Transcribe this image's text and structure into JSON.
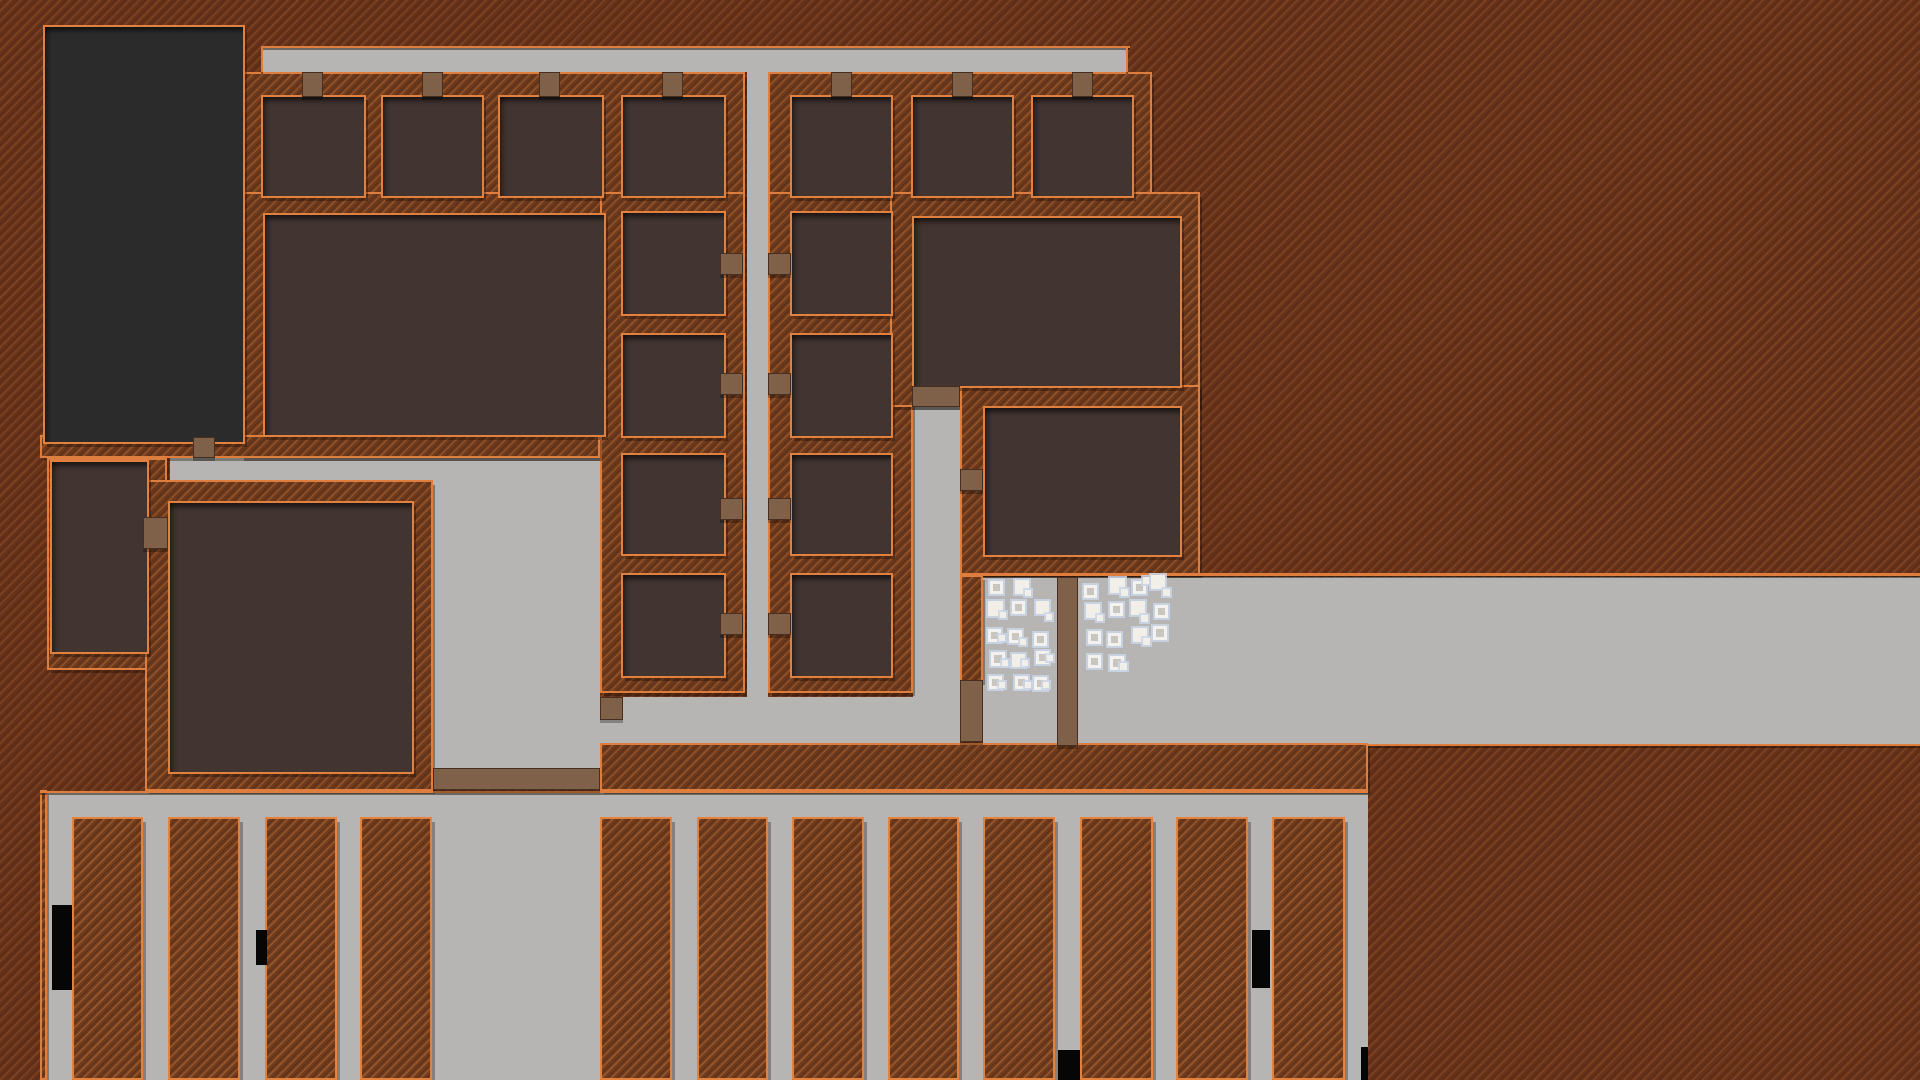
{
  "scene": {
    "description": "top-down colony builder game map, no visible text HUD",
    "palette": {
      "dirt": "#67321a",
      "dirt_stripe_light": "#7b4424",
      "dirt_stripe_dark": "#5d2b13",
      "wall_outline_orange": "#de7e3e",
      "room_interior": "#413431",
      "large_building_interior": "#2b2b2b",
      "road_gray": "#b6b5b3",
      "door_brown": "#7f6049",
      "item_white": "#f2efe9",
      "item_halo": "#cbd6e8",
      "debris_black": "#060606"
    }
  },
  "map": {
    "roads": [
      {
        "name": "top-road",
        "x": 263,
        "y": 48,
        "w": 865,
        "h": 24
      },
      {
        "name": "mid-vertical-road",
        "x": 747,
        "y": 72,
        "w": 21,
        "h": 671
      },
      {
        "name": "upper-left-road",
        "x": 170,
        "y": 458,
        "w": 263,
        "h": 22
      },
      {
        "name": "central-plaza",
        "x": 433,
        "y": 458,
        "w": 167,
        "h": 310
      },
      {
        "name": "south-corridor",
        "x": 600,
        "y": 697,
        "w": 313,
        "h": 46
      },
      {
        "name": "east-vertical-corridor",
        "x": 913,
        "y": 406,
        "w": 47,
        "h": 339
      },
      {
        "name": "east-main-road",
        "x": 983,
        "y": 577,
        "w": 937,
        "h": 168
      },
      {
        "name": "farm-yard-floor",
        "x": 47,
        "y": 793,
        "w": 1321,
        "h": 287
      }
    ],
    "wall_blocks": [
      {
        "name": "top-row-left-walls",
        "x": 240,
        "y": 72,
        "w": 505,
        "h": 143
      },
      {
        "name": "top-row-right-walls",
        "x": 768,
        "y": 72,
        "w": 384,
        "h": 143
      },
      {
        "name": "hall-block-walls",
        "x": 240,
        "y": 192,
        "w": 385,
        "h": 266
      },
      {
        "name": "left-column-walls",
        "x": 600,
        "y": 192,
        "w": 145,
        "h": 501
      },
      {
        "name": "right-column-walls",
        "x": 768,
        "y": 192,
        "w": 145,
        "h": 501
      },
      {
        "name": "northeast-hall-walls",
        "x": 890,
        "y": 192,
        "w": 310,
        "h": 215
      },
      {
        "name": "east-room-walls",
        "x": 960,
        "y": 385,
        "w": 240,
        "h": 190
      },
      {
        "name": "corridor-east-wall",
        "x": 960,
        "y": 575,
        "w": 23,
        "h": 107
      },
      {
        "name": "south-wall-slab",
        "x": 600,
        "y": 743,
        "w": 768,
        "h": 48
      },
      {
        "name": "building-south-wall",
        "x": 40,
        "y": 435,
        "w": 560,
        "h": 23
      },
      {
        "name": "small-room-walls",
        "x": 47,
        "y": 458,
        "w": 120,
        "h": 212
      },
      {
        "name": "left-hall-walls",
        "x": 145,
        "y": 480,
        "w": 288,
        "h": 311
      },
      {
        "name": "farm-left-wall",
        "x": 40,
        "y": 790,
        "w": 7,
        "h": 290
      }
    ],
    "rooms": [
      {
        "name": "large-dark-building",
        "x": 45,
        "y": 27,
        "w": 194,
        "h": 411,
        "variant": "dark"
      },
      {
        "name": "top-cell-1",
        "x": 263,
        "y": 97,
        "w": 97,
        "h": 95
      },
      {
        "name": "top-cell-2",
        "x": 383,
        "y": 97,
        "w": 95,
        "h": 95
      },
      {
        "name": "top-cell-3",
        "x": 500,
        "y": 97,
        "w": 98,
        "h": 95
      },
      {
        "name": "top-cell-4",
        "x": 623,
        "y": 97,
        "w": 97,
        "h": 95
      },
      {
        "name": "top-cell-5",
        "x": 792,
        "y": 97,
        "w": 95,
        "h": 95
      },
      {
        "name": "top-cell-6",
        "x": 913,
        "y": 97,
        "w": 95,
        "h": 95
      },
      {
        "name": "top-cell-7",
        "x": 1033,
        "y": 97,
        "w": 95,
        "h": 95
      },
      {
        "name": "central-hall",
        "x": 265,
        "y": 215,
        "w": 335,
        "h": 216
      },
      {
        "name": "left-col-cell-1",
        "x": 623,
        "y": 213,
        "w": 97,
        "h": 97
      },
      {
        "name": "left-col-cell-2",
        "x": 623,
        "y": 335,
        "w": 97,
        "h": 97
      },
      {
        "name": "left-col-cell-3",
        "x": 623,
        "y": 455,
        "w": 97,
        "h": 95
      },
      {
        "name": "left-col-cell-4",
        "x": 623,
        "y": 575,
        "w": 97,
        "h": 97
      },
      {
        "name": "right-col-cell-1",
        "x": 792,
        "y": 213,
        "w": 95,
        "h": 97
      },
      {
        "name": "right-col-cell-2",
        "x": 792,
        "y": 335,
        "w": 95,
        "h": 97
      },
      {
        "name": "right-col-cell-3",
        "x": 792,
        "y": 455,
        "w": 95,
        "h": 95
      },
      {
        "name": "right-col-cell-4",
        "x": 792,
        "y": 575,
        "w": 95,
        "h": 97
      },
      {
        "name": "northeast-hall",
        "x": 914,
        "y": 218,
        "w": 262,
        "h": 164
      },
      {
        "name": "east-room",
        "x": 985,
        "y": 408,
        "w": 191,
        "h": 143
      },
      {
        "name": "small-west-room",
        "x": 52,
        "y": 462,
        "w": 91,
        "h": 186
      },
      {
        "name": "left-hall",
        "x": 170,
        "y": 503,
        "w": 238,
        "h": 265
      }
    ],
    "doors": [
      {
        "name": "top-cell-1-door",
        "x": 302,
        "y": 72,
        "w": 21,
        "h": 25
      },
      {
        "name": "top-cell-2-door",
        "x": 422,
        "y": 72,
        "w": 21,
        "h": 25
      },
      {
        "name": "top-cell-3-door",
        "x": 539,
        "y": 72,
        "w": 21,
        "h": 25
      },
      {
        "name": "top-cell-4-door",
        "x": 662,
        "y": 72,
        "w": 21,
        "h": 25
      },
      {
        "name": "top-cell-5-door",
        "x": 831,
        "y": 72,
        "w": 21,
        "h": 25
      },
      {
        "name": "top-cell-6-door",
        "x": 952,
        "y": 72,
        "w": 21,
        "h": 25
      },
      {
        "name": "top-cell-7-door",
        "x": 1072,
        "y": 72,
        "w": 21,
        "h": 25
      },
      {
        "name": "left-col-door-1",
        "x": 720,
        "y": 253,
        "w": 23,
        "h": 22
      },
      {
        "name": "left-col-door-2",
        "x": 720,
        "y": 373,
        "w": 23,
        "h": 22
      },
      {
        "name": "left-col-door-3",
        "x": 720,
        "y": 498,
        "w": 23,
        "h": 22
      },
      {
        "name": "left-col-door-4",
        "x": 720,
        "y": 613,
        "w": 23,
        "h": 22
      },
      {
        "name": "right-col-door-1",
        "x": 768,
        "y": 253,
        "w": 23,
        "h": 22
      },
      {
        "name": "right-col-door-2",
        "x": 768,
        "y": 373,
        "w": 23,
        "h": 22
      },
      {
        "name": "right-col-door-3",
        "x": 768,
        "y": 498,
        "w": 23,
        "h": 22
      },
      {
        "name": "right-col-door-4",
        "x": 768,
        "y": 613,
        "w": 23,
        "h": 22
      },
      {
        "name": "large-building-door",
        "x": 193,
        "y": 437,
        "w": 22,
        "h": 21
      },
      {
        "name": "small-west-room-door",
        "x": 143,
        "y": 517,
        "w": 25,
        "h": 32
      },
      {
        "name": "northeast-hall-door",
        "x": 912,
        "y": 386,
        "w": 48,
        "h": 21
      },
      {
        "name": "east-room-door",
        "x": 960,
        "y": 469,
        "w": 23,
        "h": 22
      },
      {
        "name": "corridor-gate",
        "x": 960,
        "y": 680,
        "w": 23,
        "h": 62
      },
      {
        "name": "stockpile-divider-wall",
        "x": 1057,
        "y": 577,
        "w": 21,
        "h": 169
      },
      {
        "name": "corridor-post",
        "x": 600,
        "y": 697,
        "w": 23,
        "h": 23
      },
      {
        "name": "plaza-south-bridge",
        "x": 433,
        "y": 768,
        "w": 167,
        "h": 22
      }
    ],
    "fields": [
      {
        "name": "field-1",
        "x": 72,
        "y": 817,
        "w": 71,
        "h": 263
      },
      {
        "name": "field-2",
        "x": 168,
        "y": 817,
        "w": 72,
        "h": 263
      },
      {
        "name": "field-3",
        "x": 265,
        "y": 817,
        "w": 72,
        "h": 263
      },
      {
        "name": "field-4",
        "x": 360,
        "y": 817,
        "w": 72,
        "h": 263
      },
      {
        "name": "field-5",
        "x": 600,
        "y": 817,
        "w": 72,
        "h": 263
      },
      {
        "name": "field-6",
        "x": 697,
        "y": 817,
        "w": 71,
        "h": 263
      },
      {
        "name": "field-7",
        "x": 792,
        "y": 817,
        "w": 72,
        "h": 263
      },
      {
        "name": "field-8",
        "x": 888,
        "y": 817,
        "w": 71,
        "h": 263
      },
      {
        "name": "field-9",
        "x": 983,
        "y": 817,
        "w": 72,
        "h": 263
      },
      {
        "name": "field-10",
        "x": 1080,
        "y": 817,
        "w": 73,
        "h": 263
      },
      {
        "name": "field-11",
        "x": 1176,
        "y": 817,
        "w": 72,
        "h": 263
      },
      {
        "name": "field-12",
        "x": 1272,
        "y": 817,
        "w": 73,
        "h": 263
      }
    ],
    "orange_edges": [
      {
        "name": "top-road-top-edge",
        "x": 261,
        "y": 46,
        "w": 869,
        "h": 2
      },
      {
        "name": "top-road-left-edge",
        "x": 261,
        "y": 46,
        "w": 2,
        "h": 26
      },
      {
        "name": "top-road-right-edge",
        "x": 1126,
        "y": 46,
        "w": 2,
        "h": 26
      },
      {
        "name": "east-road-top-edge",
        "x": 983,
        "y": 573,
        "w": 937,
        "h": 3
      },
      {
        "name": "east-road-bottom-edge",
        "x": 1368,
        "y": 744,
        "w": 552,
        "h": 2
      },
      {
        "name": "farm-top-edge",
        "x": 40,
        "y": 791,
        "w": 1328,
        "h": 2
      }
    ],
    "debris": [
      {
        "name": "debris-1",
        "x": 52,
        "y": 905,
        "w": 20,
        "h": 85
      },
      {
        "name": "debris-2",
        "x": 256,
        "y": 930,
        "w": 11,
        "h": 35
      },
      {
        "name": "debris-3",
        "x": 1058,
        "y": 1050,
        "w": 22,
        "h": 30
      },
      {
        "name": "debris-4",
        "x": 1252,
        "y": 930,
        "w": 18,
        "h": 58
      },
      {
        "name": "debris-5",
        "x": 1361,
        "y": 1047,
        "w": 7,
        "h": 33
      }
    ],
    "stockpile_items": [
      [
        990,
        581,
        13,
        1
      ],
      [
        1015,
        580,
        14,
        0
      ],
      [
        1025,
        590,
        6,
        0
      ],
      [
        988,
        601,
        15,
        0
      ],
      [
        1000,
        612,
        6,
        0
      ],
      [
        1012,
        601,
        13,
        1
      ],
      [
        1036,
        601,
        13,
        0
      ],
      [
        1046,
        614,
        6,
        0
      ],
      [
        988,
        629,
        13,
        1
      ],
      [
        999,
        635,
        6,
        0
      ],
      [
        1009,
        630,
        13,
        1
      ],
      [
        1020,
        639,
        6,
        0
      ],
      [
        1034,
        633,
        13,
        1
      ],
      [
        991,
        652,
        14,
        1
      ],
      [
        1002,
        660,
        6,
        0
      ],
      [
        1012,
        654,
        13,
        0
      ],
      [
        1022,
        660,
        6,
        0
      ],
      [
        1036,
        651,
        13,
        1
      ],
      [
        1047,
        655,
        6,
        0
      ],
      [
        989,
        676,
        13,
        1
      ],
      [
        999,
        682,
        6,
        0
      ],
      [
        1015,
        676,
        13,
        1
      ],
      [
        1025,
        682,
        6,
        0
      ],
      [
        1034,
        677,
        13,
        1
      ],
      [
        1043,
        682,
        6,
        0
      ],
      [
        1084,
        585,
        13,
        1
      ],
      [
        1110,
        578,
        15,
        0
      ],
      [
        1121,
        589,
        7,
        0
      ],
      [
        1133,
        581,
        13,
        1
      ],
      [
        1143,
        577,
        7,
        0
      ],
      [
        1151,
        575,
        14,
        0
      ],
      [
        1163,
        589,
        7,
        0
      ],
      [
        1086,
        604,
        14,
        0
      ],
      [
        1097,
        615,
        6,
        0
      ],
      [
        1110,
        603,
        13,
        1
      ],
      [
        1131,
        601,
        14,
        0
      ],
      [
        1141,
        615,
        7,
        0
      ],
      [
        1155,
        605,
        13,
        1
      ],
      [
        1088,
        631,
        13,
        1
      ],
      [
        1108,
        633,
        13,
        1
      ],
      [
        1133,
        628,
        14,
        0
      ],
      [
        1143,
        638,
        7,
        0
      ],
      [
        1153,
        626,
        14,
        1
      ],
      [
        1088,
        655,
        13,
        1
      ],
      [
        1110,
        656,
        14,
        1
      ],
      [
        1120,
        663,
        7,
        0
      ]
    ]
  }
}
